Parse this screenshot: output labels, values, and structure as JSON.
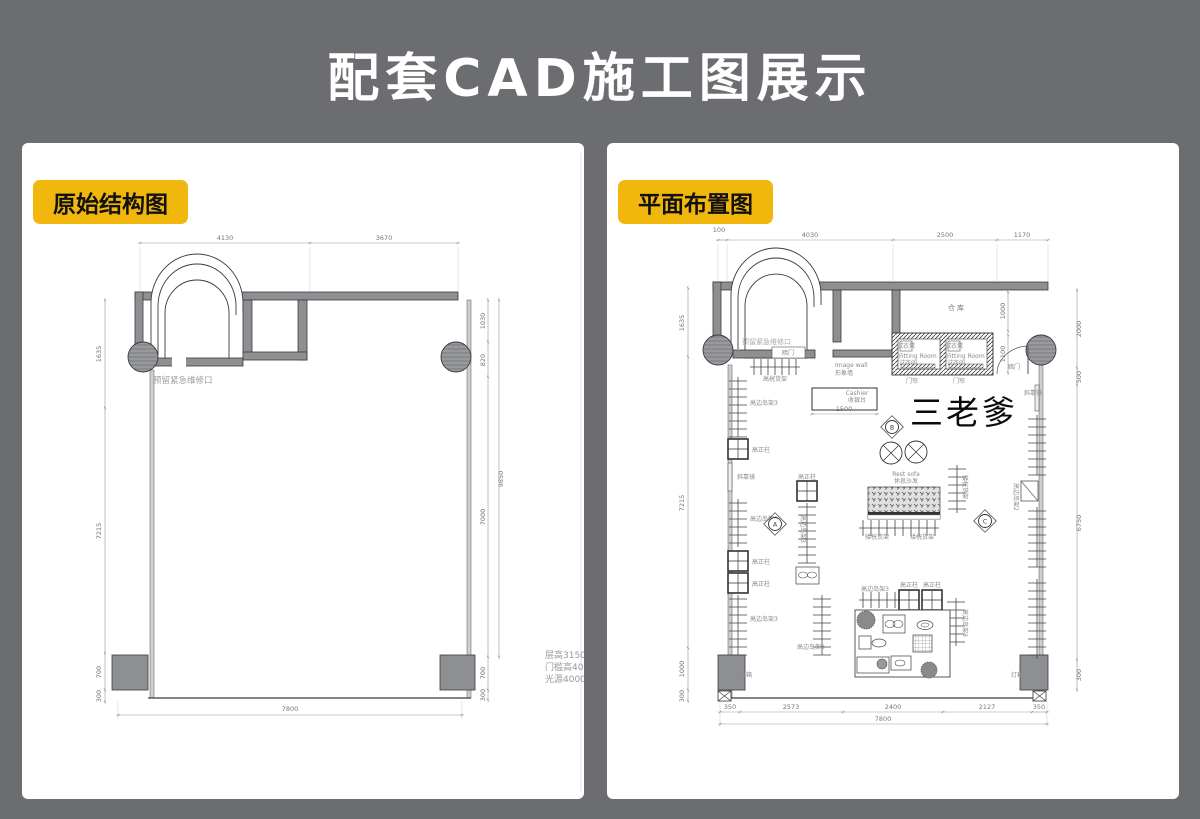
{
  "page": {
    "title": "配套CAD施工图展示",
    "bg_color": "#6b6d70",
    "accent_yellow": "#f2b70c"
  },
  "left_plan": {
    "badge": "原始结构图",
    "dim_top": [
      "4130",
      "3670"
    ],
    "dim_left": [
      "1635",
      "7215",
      "700",
      "300"
    ],
    "dim_right": [
      "1030",
      "820",
      "7000",
      "9850",
      "700",
      "300"
    ],
    "dim_bottom": "7800",
    "labels": {
      "maintenance": "预留紧急维修口"
    },
    "notes": [
      "层高3150.",
      "门槛高400",
      "光源4000K"
    ]
  },
  "right_plan": {
    "badge": "平面布置图",
    "watermark": "三老爹",
    "dim_top": [
      "100",
      "4030",
      "2500",
      "1170"
    ],
    "dim_left": [
      "1635",
      "7215",
      "1000",
      "300"
    ],
    "dim_right": [
      "2000",
      "500",
      "6750",
      "300"
    ],
    "dim_bottom": [
      "350",
      "2573",
      "2400",
      "2127",
      "350"
    ],
    "dim_bottom_total": "7800",
    "dim_inner": {
      "warehouse": "1000",
      "fitting": "1100",
      "cashier": "1500"
    },
    "labels": {
      "maintenance": "预留紧急维修口",
      "warehouse": "仓库",
      "hidden_door": "暗门",
      "door_curtain": "门帘",
      "fitting_room_en": "Fitting Room",
      "fitting_room_cn": "试衣间",
      "fitting_stool": "试衣凳",
      "image_wall_en": "Image wall",
      "image_wall_cn": "形象墙",
      "cashier_en": "Cashier",
      "cashier_cn": "收银台",
      "rack_high": "高桄货架",
      "rack_low": "矮桄货架",
      "island3": "高边岛架3",
      "island2": "高边岛架2",
      "pillar": "高正柱",
      "mirror": "斜靠镜",
      "sofa_en": "Rest sofa",
      "sofa_cn": "休息沙发",
      "lightbox": "灯箱",
      "marker_a": "A",
      "marker_b": "B",
      "marker_c": "C"
    }
  }
}
